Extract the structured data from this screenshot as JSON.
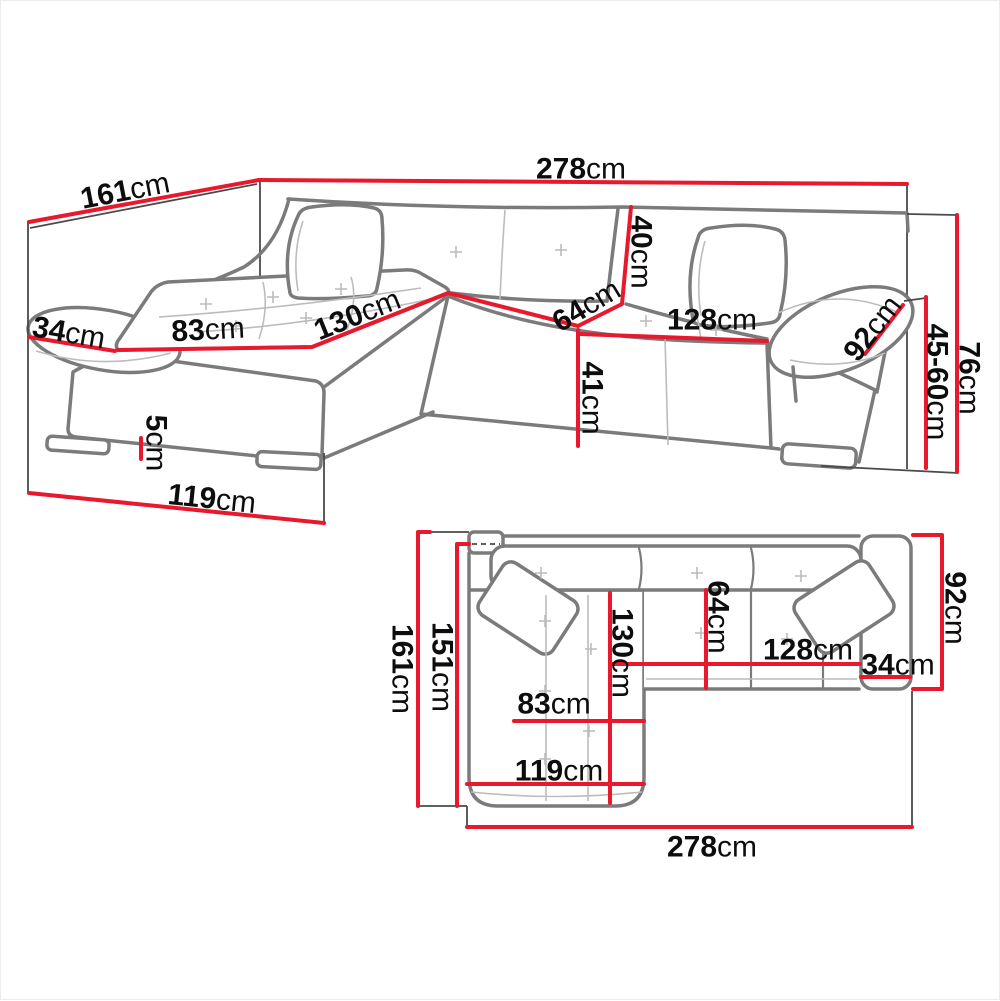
{
  "diagram_title": "Corner sofa dimension drawing",
  "unit": "cm",
  "colors": {
    "dimension_line": "#e8192d",
    "sofa_outline": "#7b7b7b",
    "light_seam": "#bcbcbc",
    "extension_line": "#4a4a4a",
    "label_text": "#0d0d0d"
  },
  "perspective_view": {
    "name": "perspective-view",
    "labels": [
      {
        "id": "total-width",
        "value": "278",
        "unit": "cm"
      },
      {
        "id": "side-depth",
        "value": "161",
        "unit": "cm"
      },
      {
        "id": "left-armrest-width",
        "value": "34",
        "unit": "cm"
      },
      {
        "id": "chaise-seat-width",
        "value": "83",
        "unit": "cm"
      },
      {
        "id": "chaise-seat-length",
        "value": "130",
        "unit": "cm"
      },
      {
        "id": "backrest-height",
        "value": "40",
        "unit": "cm"
      },
      {
        "id": "seat-depth",
        "value": "64",
        "unit": "cm"
      },
      {
        "id": "seat-width",
        "value": "128",
        "unit": "cm"
      },
      {
        "id": "seat-front-height",
        "value": "41",
        "unit": "cm"
      },
      {
        "id": "right-armrest-length",
        "value": "92",
        "unit": "cm"
      },
      {
        "id": "total-height",
        "value": "76",
        "unit": "cm"
      },
      {
        "id": "seat-height-range",
        "value": "45-60",
        "unit": "cm"
      },
      {
        "id": "leg-height",
        "value": "5",
        "unit": "cm"
      },
      {
        "id": "chaise-front-depth",
        "value": "119",
        "unit": "cm"
      }
    ]
  },
  "plan_view": {
    "name": "top-plan-view",
    "labels": [
      {
        "id": "total-depth",
        "value": "161",
        "unit": "cm"
      },
      {
        "id": "inner-depth",
        "value": "151",
        "unit": "cm"
      },
      {
        "id": "chaise-length",
        "value": "130",
        "unit": "cm"
      },
      {
        "id": "seat-depth",
        "value": "64",
        "unit": "cm"
      },
      {
        "id": "body-depth",
        "value": "92",
        "unit": "cm"
      },
      {
        "id": "seat-width",
        "value": "128",
        "unit": "cm"
      },
      {
        "id": "armrest-width",
        "value": "34",
        "unit": "cm"
      },
      {
        "id": "chaise-seat-width",
        "value": "83",
        "unit": "cm"
      },
      {
        "id": "chaise-outer-width",
        "value": "119",
        "unit": "cm"
      },
      {
        "id": "total-width",
        "value": "278",
        "unit": "cm"
      }
    ]
  }
}
